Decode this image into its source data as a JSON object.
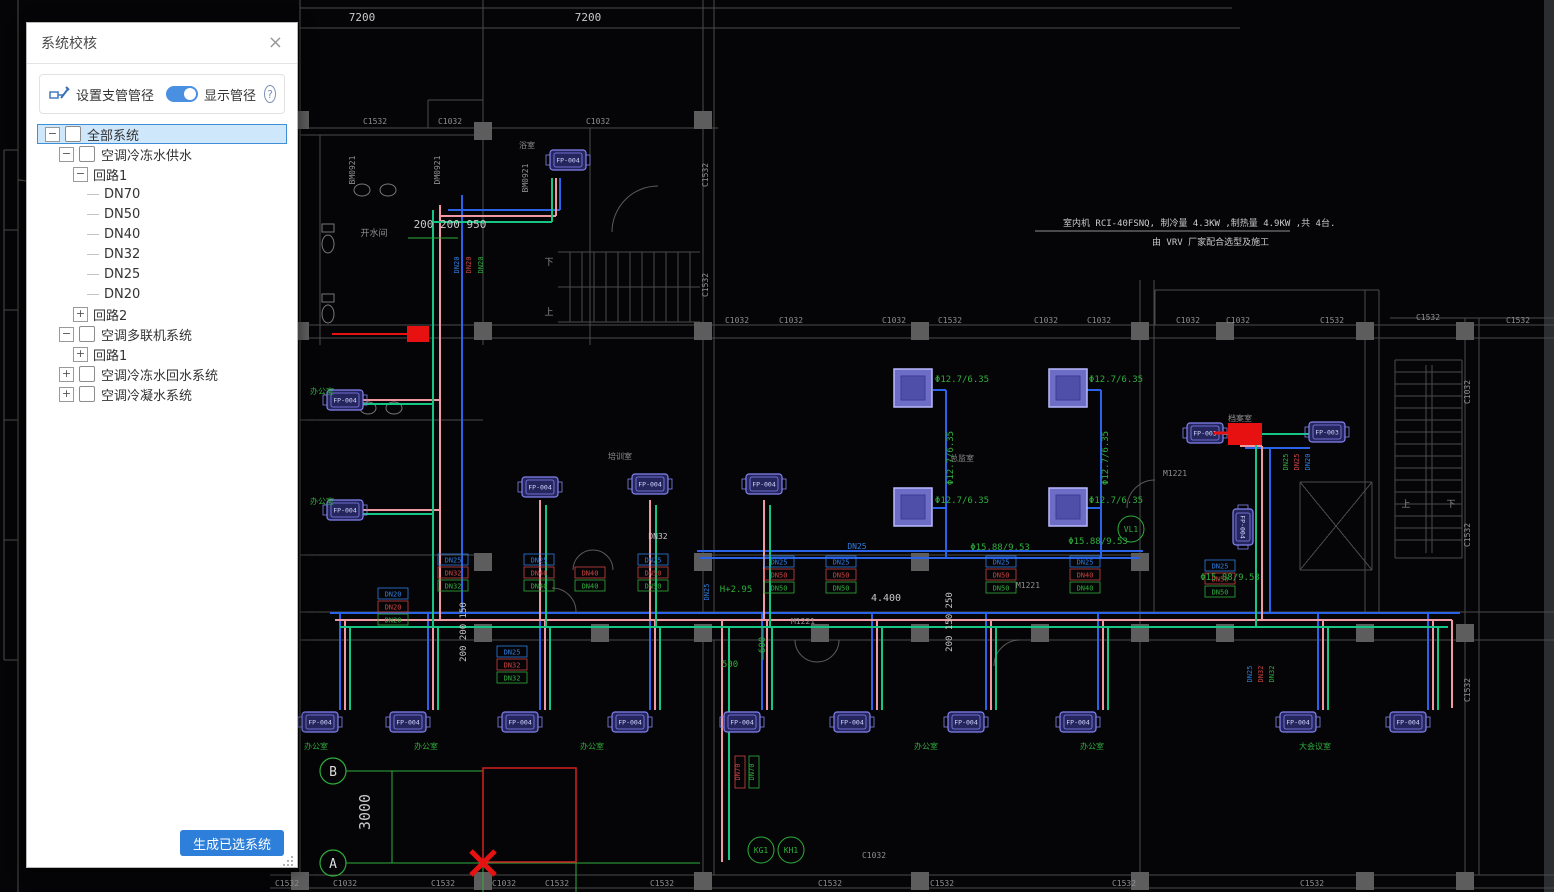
{
  "panel": {
    "title": "系统校核",
    "close_icon": "×",
    "toolbar": {
      "set_branch_label": "设置支管管径",
      "toggle_label": "显示管径",
      "toggle_on": true,
      "help_icon": "?"
    },
    "tree": [
      {
        "label": "全部系统",
        "level": 0,
        "expander": "minus",
        "checkbox": true,
        "selected": true
      },
      {
        "label": "空调冷冻水供水",
        "level": 1,
        "expander": "minus",
        "checkbox": true
      },
      {
        "label": "回路1",
        "level": 2,
        "expander": "minus"
      },
      {
        "label": "DN70",
        "level": 3
      },
      {
        "label": "DN50",
        "level": 3
      },
      {
        "label": "DN40",
        "level": 3
      },
      {
        "label": "DN32",
        "level": 3
      },
      {
        "label": "DN25",
        "level": 3
      },
      {
        "label": "DN20",
        "level": 3
      },
      {
        "label": "回路2",
        "level": 2,
        "expander": "plus"
      },
      {
        "label": "空调多联机系统",
        "level": 1,
        "expander": "minus",
        "checkbox": true
      },
      {
        "label": "回路1",
        "level": 2,
        "expander": "plus"
      },
      {
        "label": "空调冷冻水回水系统",
        "level": 1,
        "expander": "plus",
        "checkbox": true
      },
      {
        "label": "空调冷凝水系统",
        "level": 1,
        "expander": "plus",
        "checkbox": true
      }
    ],
    "generate_button": "生成已选系统"
  },
  "canvas": {
    "colors": {
      "background": "#050507",
      "wall": "#4a4a4a",
      "column": "#5d5d5d",
      "dim_text": "#c9c9c9",
      "gray_text": "#8f8f8f",
      "annotation_green": "#2fae3c",
      "pipe_blue": "#2b63e8",
      "pipe_pink": "#ef99a2",
      "pipe_green": "#16c583",
      "label_blue": "#2f7ee0",
      "label_red": "#cc4444",
      "selection_red": "#e81111",
      "unit_stroke": "#8484f2",
      "cassette_fill": "#8080e6"
    },
    "texts": [
      {
        "t": "7200",
        "x": 362,
        "y": 21,
        "c": "w",
        "s": 11
      },
      {
        "t": "7200",
        "x": 588,
        "y": 21,
        "c": "w",
        "s": 11
      },
      {
        "t": "200 200 950",
        "x": 450,
        "y": 228,
        "c": "w",
        "s": 11
      },
      {
        "t": "4.400",
        "x": 886,
        "y": 601,
        "c": "w",
        "s": 10
      },
      {
        "t": "3000",
        "x": 370,
        "y": 812,
        "c": "w",
        "s": 15,
        "r": -90
      },
      {
        "t": "200 200 150",
        "x": 466,
        "y": 632,
        "c": "w",
        "s": 9,
        "r": -90
      },
      {
        "t": "200 150 250",
        "x": 952,
        "y": 622,
        "c": "w",
        "s": 9,
        "r": -90
      },
      {
        "t": "DN32",
        "x": 658,
        "y": 539,
        "c": "w",
        "s": 8
      },
      {
        "t": "M1221",
        "x": 803,
        "y": 624,
        "c": "gr",
        "s": 8
      },
      {
        "t": "M1221",
        "x": 1028,
        "y": 588,
        "c": "gr",
        "s": 8
      },
      {
        "t": "M1221",
        "x": 1175,
        "y": 476,
        "c": "gr",
        "s": 8
      },
      {
        "t": "室内机 RCI-40FSNQ, 制冷量 4.3KW ,制热量 4.9KW ,共 4台.",
        "x": 1063,
        "y": 226,
        "c": "w",
        "s": 9,
        "a": "s"
      },
      {
        "t": "由 VRV 厂家配合选型及施工",
        "x": 1152,
        "y": 245,
        "c": "w",
        "s": 9,
        "a": "s"
      },
      {
        "t": "C1532",
        "x": 375,
        "y": 124,
        "c": "gr",
        "s": 8
      },
      {
        "t": "C1032",
        "x": 450,
        "y": 124,
        "c": "gr",
        "s": 8
      },
      {
        "t": "C1032",
        "x": 598,
        "y": 124,
        "c": "gr",
        "s": 8
      },
      {
        "t": "C1032",
        "x": 737,
        "y": 323,
        "c": "gr",
        "s": 8
      },
      {
        "t": "C1032",
        "x": 791,
        "y": 323,
        "c": "gr",
        "s": 8
      },
      {
        "t": "C1032",
        "x": 894,
        "y": 323,
        "c": "gr",
        "s": 8
      },
      {
        "t": "C1532",
        "x": 950,
        "y": 323,
        "c": "gr",
        "s": 8
      },
      {
        "t": "C1032",
        "x": 1046,
        "y": 323,
        "c": "gr",
        "s": 8
      },
      {
        "t": "C1032",
        "x": 1099,
        "y": 323,
        "c": "gr",
        "s": 8
      },
      {
        "t": "C1032",
        "x": 1188,
        "y": 323,
        "c": "gr",
        "s": 8
      },
      {
        "t": "C1032",
        "x": 1238,
        "y": 323,
        "c": "gr",
        "s": 8
      },
      {
        "t": "C1532",
        "x": 1332,
        "y": 323,
        "c": "gr",
        "s": 8
      },
      {
        "t": "C1532",
        "x": 1428,
        "y": 320,
        "c": "gr",
        "s": 8
      },
      {
        "t": "C1532",
        "x": 1518,
        "y": 323,
        "c": "gr",
        "s": 8
      },
      {
        "t": "C1532",
        "x": 287,
        "y": 886,
        "c": "gr",
        "s": 8
      },
      {
        "t": "C1032",
        "x": 345,
        "y": 886,
        "c": "gr",
        "s": 8
      },
      {
        "t": "C1532",
        "x": 443,
        "y": 886,
        "c": "gr",
        "s": 8
      },
      {
        "t": "C1032",
        "x": 504,
        "y": 886,
        "c": "gr",
        "s": 8
      },
      {
        "t": "C1532",
        "x": 557,
        "y": 886,
        "c": "gr",
        "s": 8
      },
      {
        "t": "C1532",
        "x": 662,
        "y": 886,
        "c": "gr",
        "s": 8
      },
      {
        "t": "C1532",
        "x": 830,
        "y": 886,
        "c": "gr",
        "s": 8
      },
      {
        "t": "C1032",
        "x": 874,
        "y": 858,
        "c": "gr",
        "s": 8
      },
      {
        "t": "C1532",
        "x": 942,
        "y": 886,
        "c": "gr",
        "s": 8
      },
      {
        "t": "C1532",
        "x": 1124,
        "y": 886,
        "c": "gr",
        "s": 8
      },
      {
        "t": "C1532",
        "x": 1312,
        "y": 886,
        "c": "gr",
        "s": 8
      },
      {
        "t": "C1532",
        "x": 708,
        "y": 175,
        "c": "gr",
        "s": 8,
        "r": -90
      },
      {
        "t": "C1532",
        "x": 708,
        "y": 285,
        "c": "gr",
        "s": 8,
        "r": -90
      },
      {
        "t": "C1032",
        "x": 1470,
        "y": 392,
        "c": "gr",
        "s": 8,
        "r": -90
      },
      {
        "t": "C1532",
        "x": 1470,
        "y": 535,
        "c": "gr",
        "s": 8,
        "r": -90
      },
      {
        "t": "C1532",
        "x": 1470,
        "y": 690,
        "c": "gr",
        "s": 8,
        "r": -90
      },
      {
        "t": "BM0921",
        "x": 355,
        "y": 170,
        "c": "gr",
        "s": 8,
        "r": -90
      },
      {
        "t": "DM0921",
        "x": 440,
        "y": 170,
        "c": "gr",
        "s": 8,
        "r": -90
      },
      {
        "t": "BM0921",
        "x": 528,
        "y": 178,
        "c": "gr",
        "s": 8,
        "r": -90
      },
      {
        "t": "开水间",
        "x": 374,
        "y": 236,
        "c": "gr",
        "s": 9
      },
      {
        "t": "浴室",
        "x": 527,
        "y": 148,
        "c": "gr",
        "s": 8
      },
      {
        "t": "上",
        "x": 549,
        "y": 315,
        "c": "gr",
        "s": 9
      },
      {
        "t": "下",
        "x": 549,
        "y": 265,
        "c": "gr",
        "s": 9
      },
      {
        "t": "上",
        "x": 1406,
        "y": 507,
        "c": "gr",
        "s": 9
      },
      {
        "t": "下",
        "x": 1451,
        "y": 507,
        "c": "gr",
        "s": 9
      },
      {
        "t": "档案室",
        "x": 1240,
        "y": 421,
        "c": "gr",
        "s": 8
      },
      {
        "t": "总监室",
        "x": 962,
        "y": 461,
        "c": "gr",
        "s": 8
      },
      {
        "t": "培训室",
        "x": 620,
        "y": 459,
        "c": "gr",
        "s": 8
      },
      {
        "t": "办公室",
        "x": 316,
        "y": 749,
        "c": "g",
        "s": 8
      },
      {
        "t": "办公室",
        "x": 426,
        "y": 749,
        "c": "g",
        "s": 8
      },
      {
        "t": "办公室",
        "x": 592,
        "y": 749,
        "c": "g",
        "s": 8
      },
      {
        "t": "办公室",
        "x": 926,
        "y": 749,
        "c": "g",
        "s": 8
      },
      {
        "t": "办公室",
        "x": 1092,
        "y": 749,
        "c": "g",
        "s": 8
      },
      {
        "t": "大会议室",
        "x": 1315,
        "y": 749,
        "c": "g",
        "s": 8
      },
      {
        "t": "办公室",
        "x": 322,
        "y": 394,
        "c": "g",
        "s": 8
      },
      {
        "t": "办公室",
        "x": 322,
        "y": 504,
        "c": "g",
        "s": 8
      },
      {
        "t": "H+2.95",
        "x": 736,
        "y": 592,
        "c": "g",
        "s": 9
      },
      {
        "t": "600",
        "x": 765,
        "y": 645,
        "c": "g",
        "s": 9,
        "r": -90
      },
      {
        "t": "500",
        "x": 730,
        "y": 667,
        "c": "g",
        "s": 9
      },
      {
        "t": "Φ12.7/6.35",
        "x": 962,
        "y": 382,
        "c": "g",
        "s": 9
      },
      {
        "t": "Φ12.7/6.35",
        "x": 1116,
        "y": 382,
        "c": "g",
        "s": 9
      },
      {
        "t": "Φ12.7/6.35",
        "x": 953,
        "y": 458,
        "c": "g",
        "s": 9,
        "r": -90
      },
      {
        "t": "Φ12.7/6.35",
        "x": 1108,
        "y": 458,
        "c": "g",
        "s": 9,
        "r": -90
      },
      {
        "t": "Φ12.7/6.35",
        "x": 962,
        "y": 503,
        "c": "g",
        "s": 9
      },
      {
        "t": "Φ12.7/6.35",
        "x": 1116,
        "y": 503,
        "c": "g",
        "s": 9
      },
      {
        "t": "Φ15.88/9.53",
        "x": 1000,
        "y": 550,
        "c": "g",
        "s": 9
      },
      {
        "t": "Φ15.88/9.53",
        "x": 1098,
        "y": 544,
        "c": "g",
        "s": 9
      },
      {
        "t": "Φ15.88/9.53",
        "x": 1230,
        "y": 580,
        "c": "g",
        "s": 9
      },
      {
        "t": "DN25",
        "x": 857,
        "y": 549,
        "c": "b",
        "s": 8
      }
    ],
    "dn_stacks": [
      {
        "x": 438,
        "y": 554,
        "items": [
          [
            "DN25",
            "b"
          ],
          [
            "DN32",
            "r"
          ],
          [
            "DN32",
            "g"
          ]
        ]
      },
      {
        "x": 524,
        "y": 554,
        "items": [
          [
            "DN25",
            "b"
          ],
          [
            "DN40",
            "r"
          ],
          [
            "DN40",
            "g"
          ]
        ]
      },
      {
        "x": 575,
        "y": 567,
        "items": [
          [
            "DN40",
            "r"
          ],
          [
            "DN40",
            "g"
          ]
        ]
      },
      {
        "x": 638,
        "y": 554,
        "items": [
          [
            "DN25",
            "b"
          ],
          [
            "DN50",
            "r"
          ],
          [
            "DN50",
            "g"
          ]
        ]
      },
      {
        "x": 764,
        "y": 556,
        "items": [
          [
            "DN25",
            "b"
          ],
          [
            "DN50",
            "r"
          ],
          [
            "DN50",
            "g"
          ]
        ]
      },
      {
        "x": 826,
        "y": 556,
        "items": [
          [
            "DN25",
            "b"
          ],
          [
            "DN50",
            "r"
          ],
          [
            "DN50",
            "g"
          ]
        ]
      },
      {
        "x": 986,
        "y": 556,
        "items": [
          [
            "DN25",
            "b"
          ],
          [
            "DN50",
            "r"
          ],
          [
            "DN50",
            "g"
          ]
        ]
      },
      {
        "x": 1070,
        "y": 556,
        "items": [
          [
            "DN25",
            "b"
          ],
          [
            "DN40",
            "r"
          ],
          [
            "DN40",
            "g"
          ]
        ]
      },
      {
        "x": 1205,
        "y": 560,
        "items": [
          [
            "DN25",
            "b"
          ],
          [
            "DN50",
            "r"
          ],
          [
            "DN50",
            "g"
          ]
        ]
      },
      {
        "x": 497,
        "y": 646,
        "items": [
          [
            "DN25",
            "b"
          ],
          [
            "DN32",
            "r"
          ],
          [
            "DN32",
            "g"
          ]
        ]
      },
      {
        "x": 378,
        "y": 588,
        "items": [
          [
            "DN20",
            "b"
          ],
          [
            "DN20",
            "r"
          ],
          [
            "DN20",
            "g"
          ]
        ]
      }
    ],
    "dn_vertical": [
      {
        "t": "DN20",
        "x": 459,
        "y": 265,
        "c": "b"
      },
      {
        "t": "DN20",
        "x": 471,
        "y": 265,
        "c": "r"
      },
      {
        "t": "DN20",
        "x": 483,
        "y": 265,
        "c": "g"
      },
      {
        "t": "DN25",
        "x": 709,
        "y": 592,
        "c": "b"
      },
      {
        "t": "DN70",
        "x": 740,
        "y": 772,
        "c": "r",
        "boxed": true
      },
      {
        "t": "DN70",
        "x": 754,
        "y": 772,
        "c": "g",
        "boxed": true
      },
      {
        "t": "DN25",
        "x": 1288,
        "y": 462,
        "c": "g"
      },
      {
        "t": "DN25",
        "x": 1299,
        "y": 462,
        "c": "r"
      },
      {
        "t": "DN20",
        "x": 1310,
        "y": 462,
        "c": "b"
      },
      {
        "t": "DN25",
        "x": 1252,
        "y": 674,
        "c": "b"
      },
      {
        "t": "DN32",
        "x": 1263,
        "y": 674,
        "c": "r"
      },
      {
        "t": "DN32",
        "x": 1274,
        "y": 674,
        "c": "g"
      }
    ],
    "fp_units": [
      {
        "label": "FP-004",
        "x": 320,
        "y": 722
      },
      {
        "label": "FP-004",
        "x": 408,
        "y": 722
      },
      {
        "label": "FP-004",
        "x": 520,
        "y": 722
      },
      {
        "label": "FP-004",
        "x": 630,
        "y": 722
      },
      {
        "label": "FP-004",
        "x": 742,
        "y": 722
      },
      {
        "label": "FP-004",
        "x": 852,
        "y": 722
      },
      {
        "label": "FP-004",
        "x": 966,
        "y": 722
      },
      {
        "label": "FP-004",
        "x": 1078,
        "y": 722
      },
      {
        "label": "FP-004",
        "x": 1298,
        "y": 722
      },
      {
        "label": "FP-004",
        "x": 1408,
        "y": 722
      },
      {
        "label": "FP-004",
        "x": 345,
        "y": 400
      },
      {
        "label": "FP-004",
        "x": 345,
        "y": 510
      },
      {
        "label": "FP-004",
        "x": 540,
        "y": 487
      },
      {
        "label": "FP-004",
        "x": 650,
        "y": 484
      },
      {
        "label": "FP-004",
        "x": 764,
        "y": 484
      },
      {
        "label": "FP-004",
        "x": 568,
        "y": 160
      },
      {
        "label": "FP-003",
        "x": 1205,
        "y": 433
      },
      {
        "label": "FP-003",
        "x": 1327,
        "y": 432
      },
      {
        "label": "FP-004",
        "x": 1243,
        "y": 527,
        "rot": 90
      }
    ],
    "cassettes": [
      {
        "x": 913,
        "y": 388
      },
      {
        "x": 1068,
        "y": 388
      },
      {
        "x": 913,
        "y": 507
      },
      {
        "x": 1068,
        "y": 507
      }
    ],
    "grid_bubbles": [
      {
        "label": "B",
        "x": 333,
        "y": 771
      },
      {
        "label": "A",
        "x": 333,
        "y": 863
      }
    ],
    "circle_tags": [
      {
        "label": "KG1",
        "x": 761,
        "y": 850
      },
      {
        "label": "KH1",
        "x": 791,
        "y": 850
      },
      {
        "label": "VL1",
        "x": 1131,
        "y": 529
      }
    ]
  }
}
